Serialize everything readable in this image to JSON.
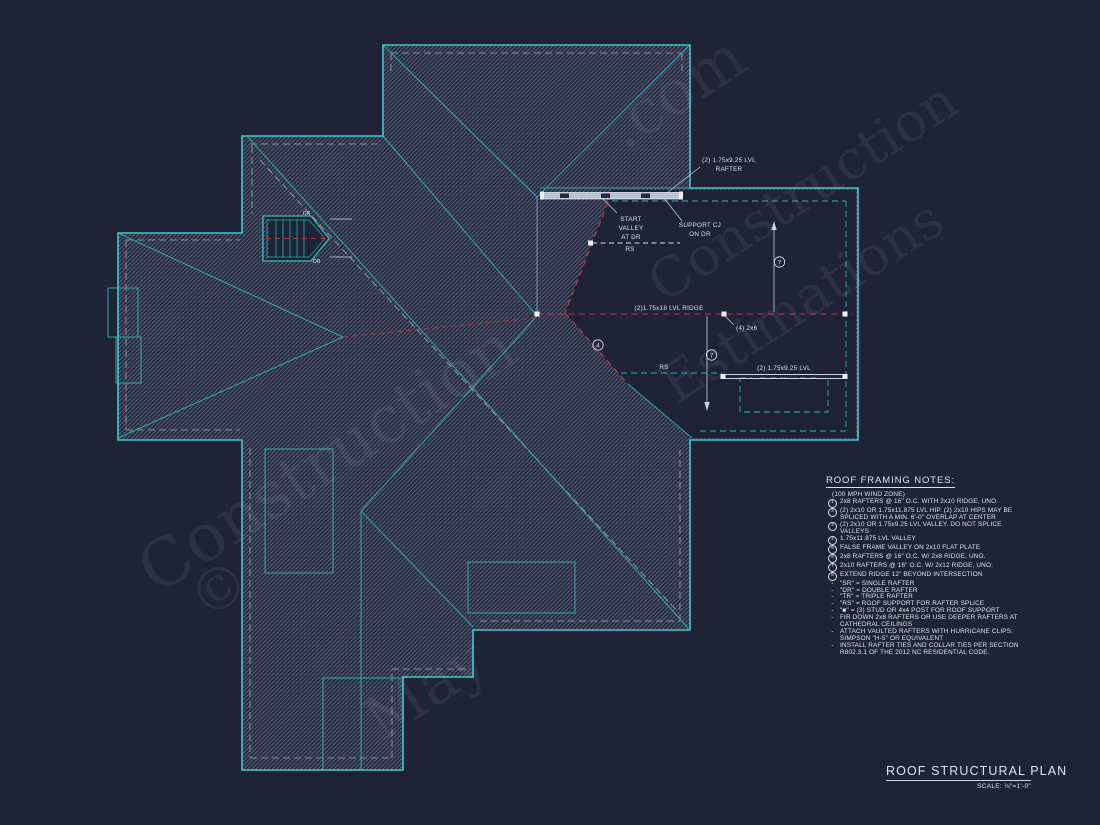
{
  "colors": {
    "background": "#1f2336",
    "teal": "#41c7cb",
    "teal_dim": "#2fa6ad",
    "red_ridge": "#c0394a",
    "grey_line": "#c9d0de",
    "text": "#dfe3ec"
  },
  "plan": {
    "rafter1a": "(2) 1.75x9.25 LVL",
    "rafter1b": "RAFTER",
    "sv0": "START",
    "sv1": "VALLEY",
    "sv2": "AT DR",
    "cj0": "SUPPORT CJ",
    "cj1": "ON DR",
    "ridge": "(2)1.75x18 LVL RIDGE",
    "post": "(4) 2x6",
    "beam2": "(2) 1.75x9.25 LVL",
    "rs": "RS",
    "dr": "DR",
    "c4": "4",
    "c7": "7"
  },
  "notes": {
    "title": "ROOF FRAMING NOTES:",
    "subtitle": "(100 MPH WIND ZONE)",
    "items": [
      {
        "m": "1",
        "t": "2x8 RAFTERS @ 16\" O.C. WITH 2x10 RIDGE, UNO."
      },
      {
        "m": "2",
        "t": "(2) 2x10 OR 1.75x11.875 LVL HIP. (2) 2x10 HIPS MAY BE SPLICED WITH A MIN. 6'-0\" OVERLAP AT CENTER"
      },
      {
        "m": "3",
        "t": "(2) 2x10 OR 1.75x9.25 LVL VALLEY. DO NOT SPLICE VALLEYS"
      },
      {
        "m": "4",
        "t": "1.75x11.875 LVL VALLEY"
      },
      {
        "m": "5",
        "t": "FALSE FRAME VALLEY ON 2x10 FLAT PLATE"
      },
      {
        "m": "6",
        "t": "2x8 RAFTERS @ 16\" O.C. W/ 2x8 RIDGE, UNO."
      },
      {
        "m": "7",
        "t": "2x10 RAFTERS @ 16\" O.C. W/ 2x12 RIDGE, UNO."
      },
      {
        "m": "8",
        "t": "EXTEND RIDGE 12\" BEYOND INTERSECTION"
      },
      {
        "m": "-",
        "t": "\"SR\" = SINGLE RAFTER"
      },
      {
        "m": "-",
        "t": "\"DR\" = DOUBLE RAFTER"
      },
      {
        "m": "-",
        "t": "\"TR\" = TRIPLE RAFTER"
      },
      {
        "m": "-",
        "t": "\"RS\" = ROOF SUPPORT FOR RAFTER SPLICE"
      },
      {
        "m": "-",
        "t": "\"■\" = (3) STUD OR 4x4 POST FOR ROOF SUPPORT"
      },
      {
        "m": "-",
        "t": "FIR DOWN 2x8 RAFTERS OR USE DEEPER RAFTERS AT CATHEDRAL CEILINGS"
      },
      {
        "m": "-",
        "t": "ATTACH VAULTED RAFTERS WITH HURRICANE CLIPS: SIMPSON \"H-5\" OR EQUIVALENT"
      },
      {
        "m": "-",
        "t": "INSTALL RAFTER TIES AND COLLAR TIES PER SECTION R802.3.1 OF THE 2012 NC RESIDENTIAL CODE."
      }
    ]
  },
  "title_block": {
    "title": "ROOF STRUCTURAL PLAN",
    "scale": "SCALE: ⅛\"=1'-0\""
  },
  "watermark": {
    "lines": [
      {
        "text": ".com",
        "x": 600,
        "y": 55,
        "size": 62
      },
      {
        "text": "Construction",
        "x": 625,
        "y": 160,
        "size": 54
      },
      {
        "text": "Estimations",
        "x": 640,
        "y": 270,
        "size": 54
      },
      {
        "text": "Construction",
        "x": 110,
        "y": 420,
        "size": 66
      },
      {
        "text": "©",
        "x": 190,
        "y": 555,
        "size": 58
      },
      {
        "text": "May",
        "x": 360,
        "y": 655,
        "size": 60
      }
    ]
  }
}
